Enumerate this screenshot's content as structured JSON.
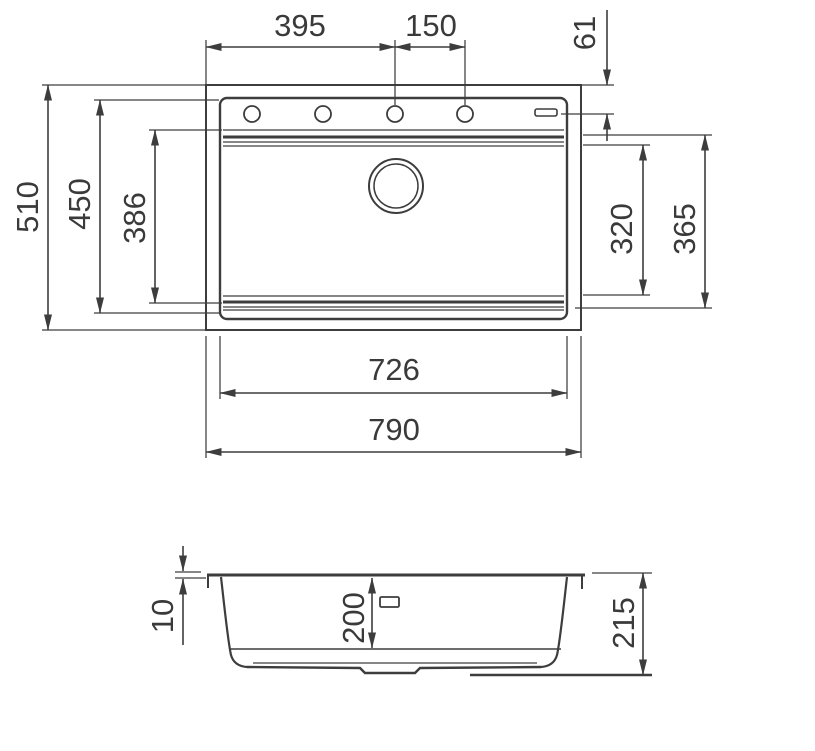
{
  "colors": {
    "line": "#3d3d3d",
    "text": "#3a3a3a",
    "background": "#ffffff"
  },
  "views": {
    "top": {
      "dims": {
        "faucet_offset": "395",
        "hole_spacing": "150",
        "edge_to_hole_center": "61",
        "overall_depth": "510",
        "bowl_outer_depth": "450",
        "basin_opening_depth": "386",
        "basin_inner_depth_right": "320",
        "basin_outer_depth_right": "365",
        "bowl_width": "726",
        "overall_width": "790"
      }
    },
    "section": {
      "dims": {
        "rim_height": "10",
        "basin_depth": "200",
        "overall_height": "215"
      }
    }
  },
  "stray_mark": "’"
}
